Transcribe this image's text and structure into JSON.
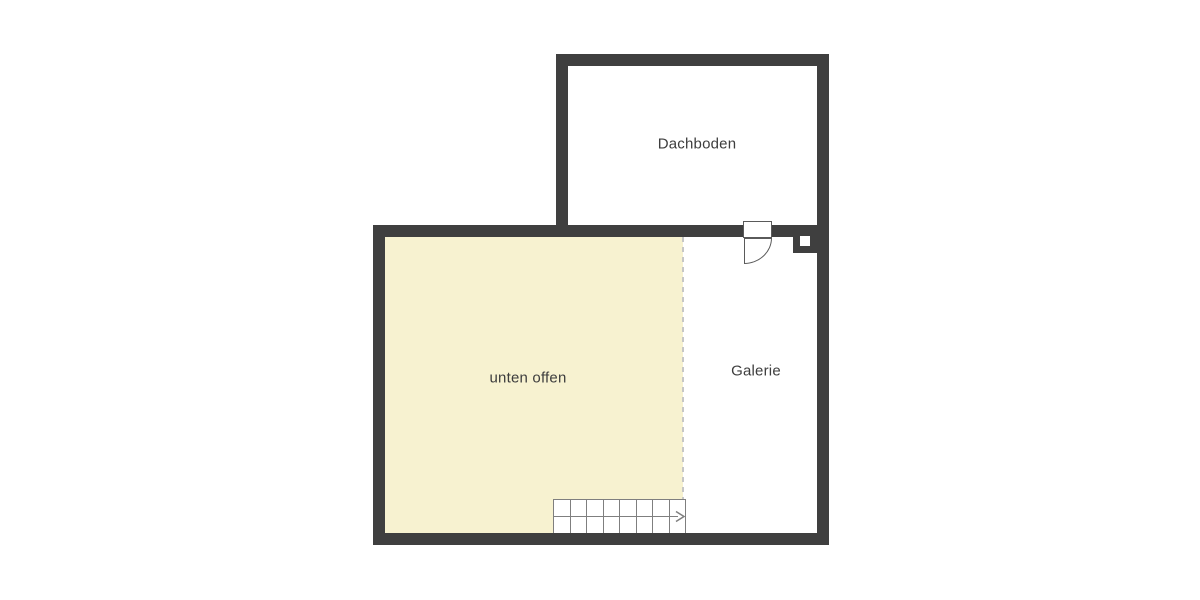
{
  "plan": {
    "title": "Obergeschoss-Grundriss",
    "rooms": [
      {
        "id": "dachboden",
        "label": "Dachboden"
      },
      {
        "id": "unten-offen",
        "label": "unten offen"
      },
      {
        "id": "galerie",
        "label": "Galerie"
      }
    ],
    "stairs": {
      "step_count": 8,
      "direction": "right",
      "arrow_icon": "right-arrow"
    },
    "symbols": [
      {
        "id": "door",
        "description": "door with quarter-circle swing into Galerie"
      },
      {
        "id": "chimney",
        "description": "chimney block on right wall"
      }
    ],
    "colors": {
      "wall": "#3f3f3f",
      "open_area_fill": "#f7f2d0",
      "room_fill": "#ffffff",
      "dashed_line": "#c6c6c6",
      "stair_line": "#7f7f7f",
      "label_text": "#3d3d3d"
    }
  }
}
